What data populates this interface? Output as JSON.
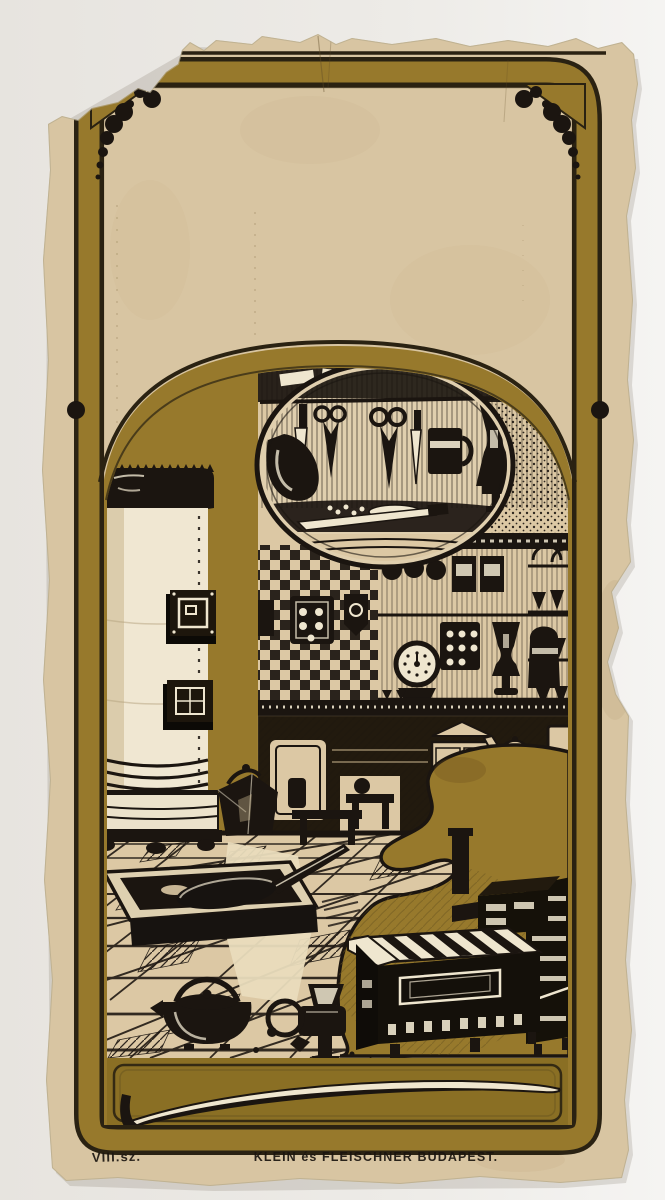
{
  "card": {
    "caption": {
      "left": "VIII.sz.",
      "center": "KLEIN és FLEISCHNER BUDAPEST."
    },
    "colors": {
      "scan-bg": "#ebe9e5",
      "paper": "#d8c5a2",
      "paper-light": "#e0cfad",
      "illus-beige": "#dcc8a4",
      "highlight-white": "#efe6cf",
      "gold": "#97792c",
      "gold-deep": "#8a6f24",
      "gold-dark": "#6d5820",
      "outline": "#2a2212",
      "ink": "#1b1510"
    },
    "illustration_motifs": [
      "tile-stove",
      "scissors-and-cutlery-vignette",
      "checkerboard-tile-wall",
      "kitchen-shelves",
      "kitchen-dresser",
      "perspective-tiled-floor",
      "roasting-pan-with-skillet",
      "kettle",
      "meat-grinder",
      "kitchen-range",
      "art-nouveau-gold-swirl",
      "whiplash-swoosh-ornament",
      "corner-dot-clusters"
    ]
  }
}
